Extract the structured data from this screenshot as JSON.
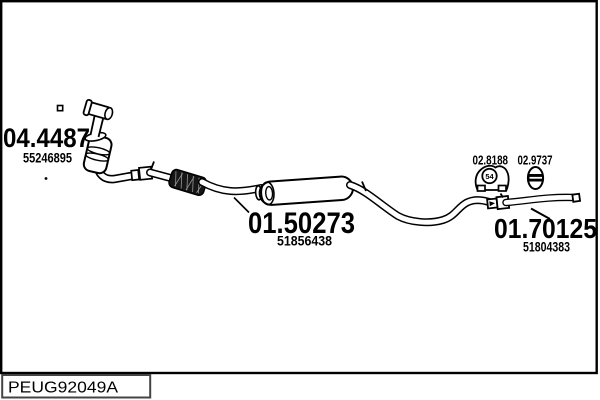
{
  "colors": {
    "line": "#000000",
    "background": "#ffffff",
    "flex_fill": "#161616",
    "code_box_border": "#444444"
  },
  "parts": {
    "catalyst": {
      "number": "04.4487",
      "ref": "55246895"
    },
    "middle_silencer": {
      "number": "01.50273",
      "ref": "51856438"
    },
    "rear_pipe": {
      "number": "01.70125",
      "ref": "51804383"
    },
    "rubber_mount": {
      "number": "02.8188",
      "marking": "54"
    },
    "clamp": {
      "number": "02.9737"
    }
  },
  "icons": {
    "rubber_mount_icon": "rubber-hanger-mount",
    "clamp_icon": "pipe-clamp"
  },
  "footer": {
    "diagram_code": "PEUG92049A"
  }
}
